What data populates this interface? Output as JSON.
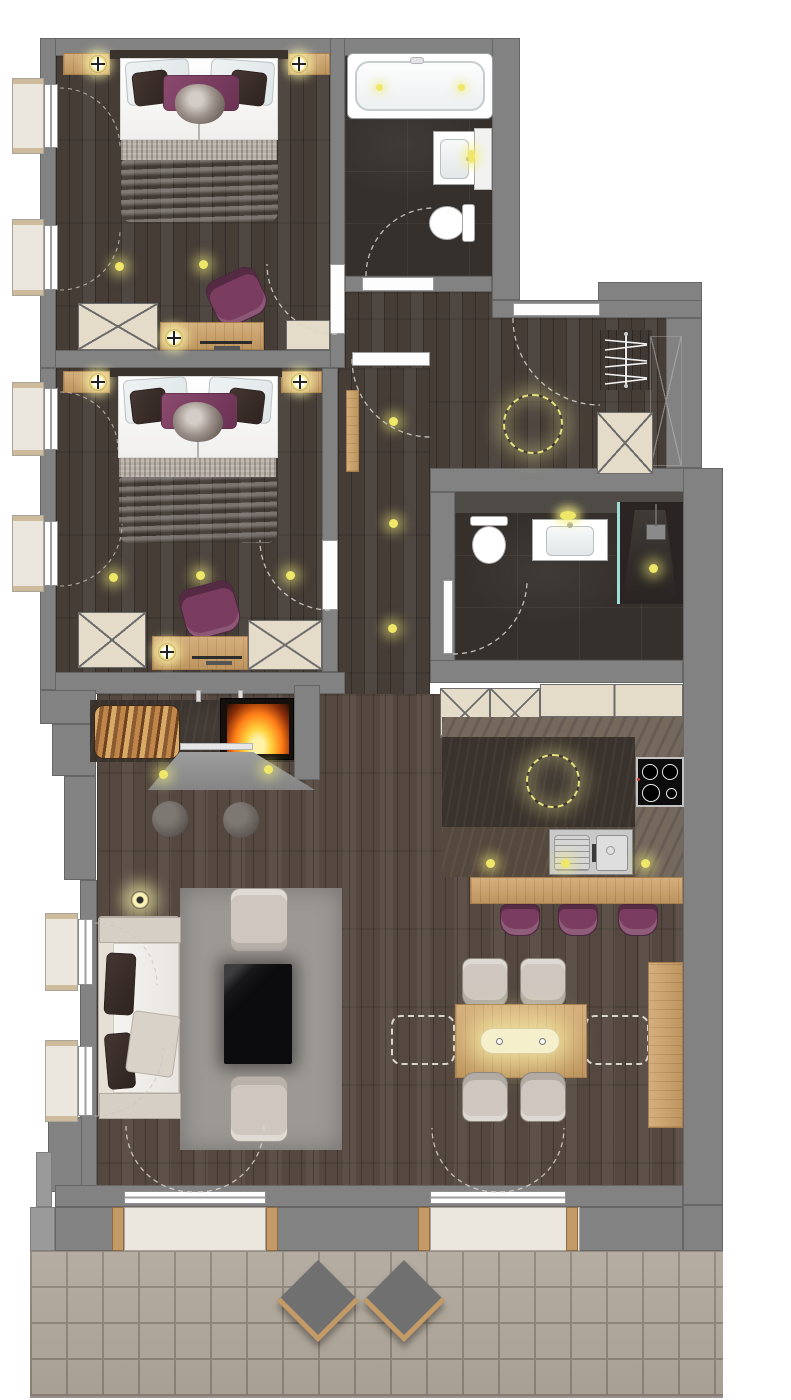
{
  "meta": {
    "title": "apartment-floor-plan",
    "view": "top-down-rendered-plan",
    "visible_text": "none"
  },
  "colors": {
    "wall": "#828282",
    "wallEdge": "#666666",
    "wallLight": "#9a9a9a",
    "wallDark": "#4e4a46",
    "woodFloor": "#463d37",
    "woodFloorLight": "#544840",
    "bathFloor": "#36302c",
    "stoneLight": "#75695e",
    "stoneMid": "#55483d",
    "stoneDark": "#3a322c",
    "oak": "#cda167",
    "oakDark": "#a77f4e",
    "cream": "#e5dbc9",
    "purple": "#7a3d60",
    "sofa": "#e5dfd6",
    "rug": "#9c9894",
    "chairGray": "#cfc7bf",
    "tvBlack": "#0c0c0e",
    "terraceTile": "#b1a89c",
    "terraceJoint": "#8d8579",
    "glowYellow": "#efe768",
    "glassTeal": "#9fded6",
    "trimTan": "#c49a66",
    "fireMid": "#ff7c17"
  },
  "rooms": [
    {
      "name": "bedroom-1",
      "windows": 2,
      "furniture": [
        "double-bed",
        "nightstand-left",
        "nightstand-right",
        "reading-lamp-x2",
        "purple-armchair",
        "x-dresser",
        "desk-with-lamp",
        "ceiling-spot-x2"
      ]
    },
    {
      "name": "bathroom-1",
      "furniture": [
        "bathtub",
        "washbasin",
        "toilet"
      ],
      "lights": [
        "tub-spot-x2",
        "mirror-glow"
      ]
    },
    {
      "name": "entry-hall",
      "furniture": [
        "entry-door",
        "coat-rack-with-hangers",
        "x-shoe-cabinet",
        "dashed-ring-ceiling-light"
      ]
    },
    {
      "name": "corridor",
      "furniture": [
        "wall-bench"
      ],
      "lights": [
        "ceiling-spot-x3"
      ]
    },
    {
      "name": "bedroom-2",
      "windows": 2,
      "furniture": [
        "double-bed",
        "nightstand-x2",
        "reading-lamp-x2",
        "purple-armchair",
        "x-dresser-x2",
        "desk-with-lamp",
        "ceiling-spot-x3"
      ]
    },
    {
      "name": "bathroom-2",
      "furniture": [
        "toilet",
        "washbasin-vanity",
        "walk-in-shower",
        "glass-screen"
      ],
      "lights": [
        "mirror-glow",
        "shower-spot"
      ]
    },
    {
      "name": "kitchen",
      "furniture": [
        "x-tall-cabinet-x2",
        "upper-cabinet-row",
        "dark-stone-island",
        "induction-hob-4-zones",
        "sink-with-drainer",
        "oak-bar-counter",
        "purple-bar-stool-x3"
      ],
      "lights": [
        "dashed-ring-ceiling-light",
        "ceiling-spot-x3"
      ]
    },
    {
      "name": "living-room",
      "windows": 2,
      "furniture": [
        "fireplace",
        "firewood-stack",
        "chimney-hood",
        "pouf-x2",
        "sofa-with-pillows",
        "floor-lamp",
        "armchair-x2",
        "tv-black-board",
        "gray-rug"
      ],
      "lights": [
        "fireplace-spot-x2"
      ]
    },
    {
      "name": "dining-area",
      "furniture": [
        "oak-dining-table",
        "pendant-light",
        "upholstered-chair-x4",
        "dashed-ghost-chair-x2",
        "oak-sideboard"
      ]
    },
    {
      "name": "terrace",
      "flooring": "stone-tile-grid",
      "furniture": [
        "diamond-lounge-chair-x2"
      ],
      "access": [
        "balcony-double-door-x2"
      ]
    }
  ],
  "openings": {
    "windows_left_wall": 6,
    "balcony_double_doors": 2,
    "interior_doors": [
      "bedroom-1",
      "bedroom-2",
      "bathroom-1",
      "bathroom-2",
      "corridor"
    ],
    "entry_door": 1
  },
  "lighting_totals": {
    "ceiling_spots": 14,
    "dashed_ring_lights": 2,
    "table_lamps": 6,
    "pendant": 1,
    "floor_lamp": 1,
    "mirror_glows": 2
  }
}
